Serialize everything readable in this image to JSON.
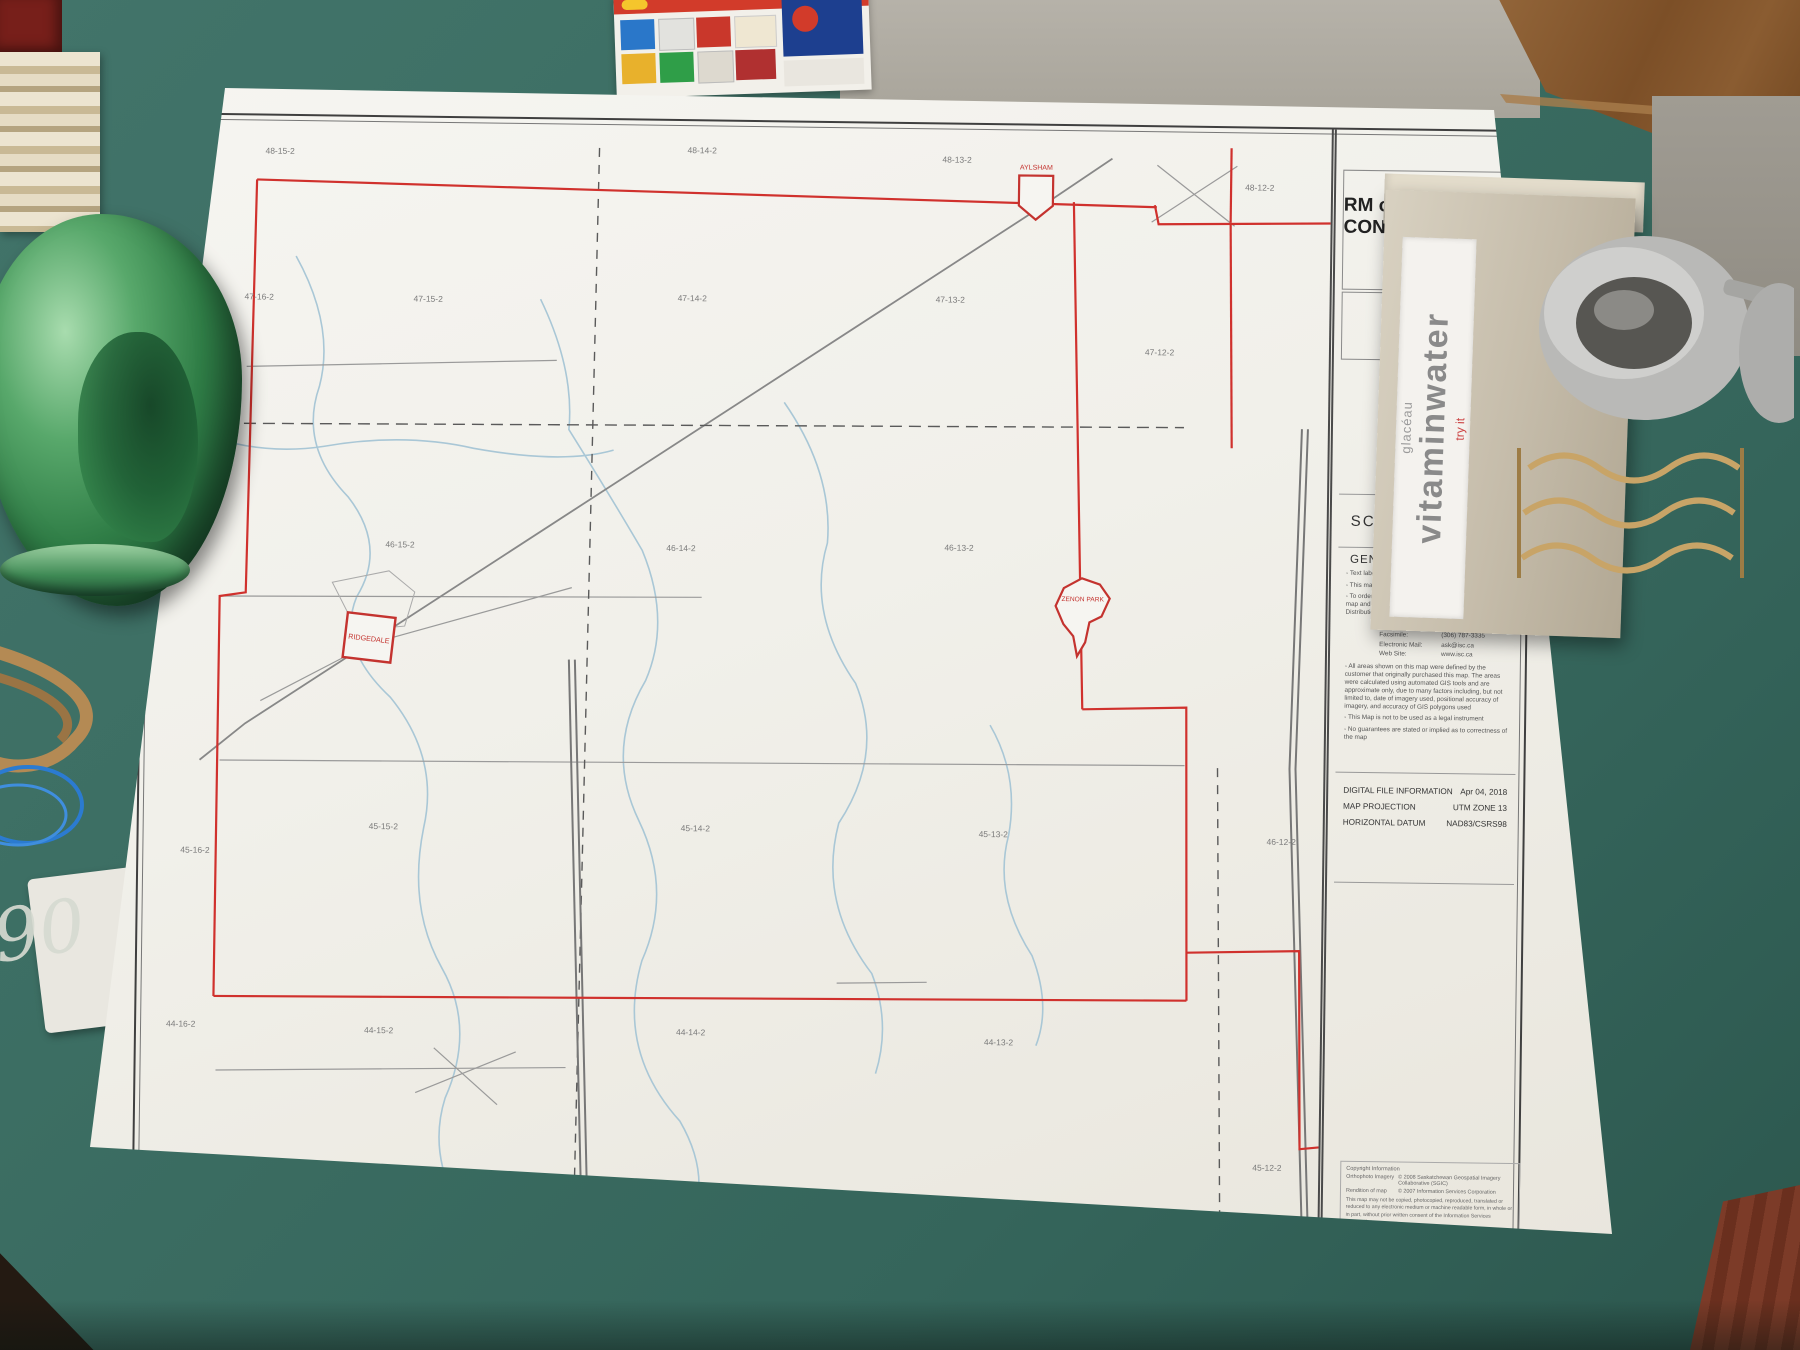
{
  "map_sheet": {
    "title_line1": "RM of CONNAUGHT",
    "title_line2": "#457",
    "logo_text": "ISC",
    "scale_label": "SCALE",
    "scale_value": "1:58,000",
    "general_information": {
      "heading": "GENERAL INFORMATION",
      "note1": "- Text labels obtained from SaskGIS Cadastral Dataset",
      "note2": "- This map is available in hardcopy format only",
      "note3": "- To order this map, or for further information about this map and other products, please contact the Geomatics Distribution Centre at:",
      "contact": {
        "toll_free_label": "Toll Free:",
        "toll_free_value": "1-866-275-4721",
        "fax_label": "Facsimile:",
        "fax_value": "(306) 787-3335",
        "email_label": "Electronic Mail:",
        "email_value": "ask@isc.ca",
        "web_label": "Web Site:",
        "web_value": "www.isc.ca"
      },
      "disclaimer1": "- All areas shown on this map were defined by the customer that originally purchased this map. The areas were calculated using automated GIS tools and are approximate only, due to many factors including, but not limited to, date of imagery used, positional accuracy of imagery, and accuracy of GIS polygons used",
      "disclaimer2": "- This Map is not to be used as a legal instrument",
      "disclaimer3": "- No guarantees are stated or implied as to correctness of the map"
    },
    "file_info": {
      "row1_label": "DIGITAL FILE INFORMATION",
      "row1_value": "Apr 04, 2018",
      "row2_label": "MAP PROJECTION",
      "row2_value": "UTM ZONE 13",
      "row3_label": "HORIZONTAL DATUM",
      "row3_value": "NAD83/CSRS98"
    },
    "copyright": {
      "heading": "Copyright Information",
      "row1_label": "Orthophoto Imagery",
      "row1_value": "© 2008 Saskatchewan Geospatial Imagery Collaborative (SGIC)",
      "row2_label": "Rendition of map",
      "row2_value": "© 2007 Information Services Corporation",
      "paragraph": "This map may not be copied, photocopied, reproduced, translated or reduced to any electronic medium or machine readable form, in whole or in part, without prior written consent of the Information Services Corporation."
    },
    "towns": [
      {
        "name": "AYLSHAM"
      },
      {
        "name": "RIDGEDALE"
      },
      {
        "name": "ZENON PARK"
      }
    ],
    "township_labels": [
      {
        "t": "48-15-2",
        "x": 118,
        "y": 38
      },
      {
        "t": "48-14-2",
        "x": 540,
        "y": 32
      },
      {
        "t": "48-13-2",
        "x": 795,
        "y": 38
      },
      {
        "t": "48-12-2",
        "x": 1098,
        "y": 62
      },
      {
        "t": "47-16-2",
        "x": 99,
        "y": 184
      },
      {
        "t": "47-15-2",
        "x": 268,
        "y": 184
      },
      {
        "t": "47-14-2",
        "x": 532,
        "y": 180
      },
      {
        "t": "47-13-2",
        "x": 790,
        "y": 178
      },
      {
        "t": "47-12-2",
        "x": 1000,
        "y": 228
      },
      {
        "t": "46-15-2",
        "x": 243,
        "y": 430
      },
      {
        "t": "46-14-2",
        "x": 524,
        "y": 430
      },
      {
        "t": "46-13-2",
        "x": 802,
        "y": 426
      },
      {
        "t": "46-12-2",
        "x": 1128,
        "y": 716
      },
      {
        "t": "45-16-2",
        "x": 42,
        "y": 738
      },
      {
        "t": "45-15-2",
        "x": 230,
        "y": 712
      },
      {
        "t": "45-14-2",
        "x": 542,
        "y": 710
      },
      {
        "t": "45-13-2",
        "x": 840,
        "y": 712
      },
      {
        "t": "45-12-2",
        "x": 1118,
        "y": 1042
      },
      {
        "t": "44-16-2",
        "x": 30,
        "y": 912
      },
      {
        "t": "44-15-2",
        "x": 228,
        "y": 916
      },
      {
        "t": "44-14-2",
        "x": 540,
        "y": 914
      },
      {
        "t": "44-13-2",
        "x": 848,
        "y": 920
      }
    ],
    "colors": {
      "boundary_red": "#d0312d",
      "water_blue": "#a9c7d6",
      "road_gray": "#8e8e8e",
      "logo_blue": "#1d4f91",
      "logo_cyan": "#8fd8ea"
    }
  },
  "surroundings": {
    "handwriting": "90",
    "box_label_sub": "glacéau",
    "box_label_main": "vitaminwater",
    "box_label_tag": "try it"
  }
}
